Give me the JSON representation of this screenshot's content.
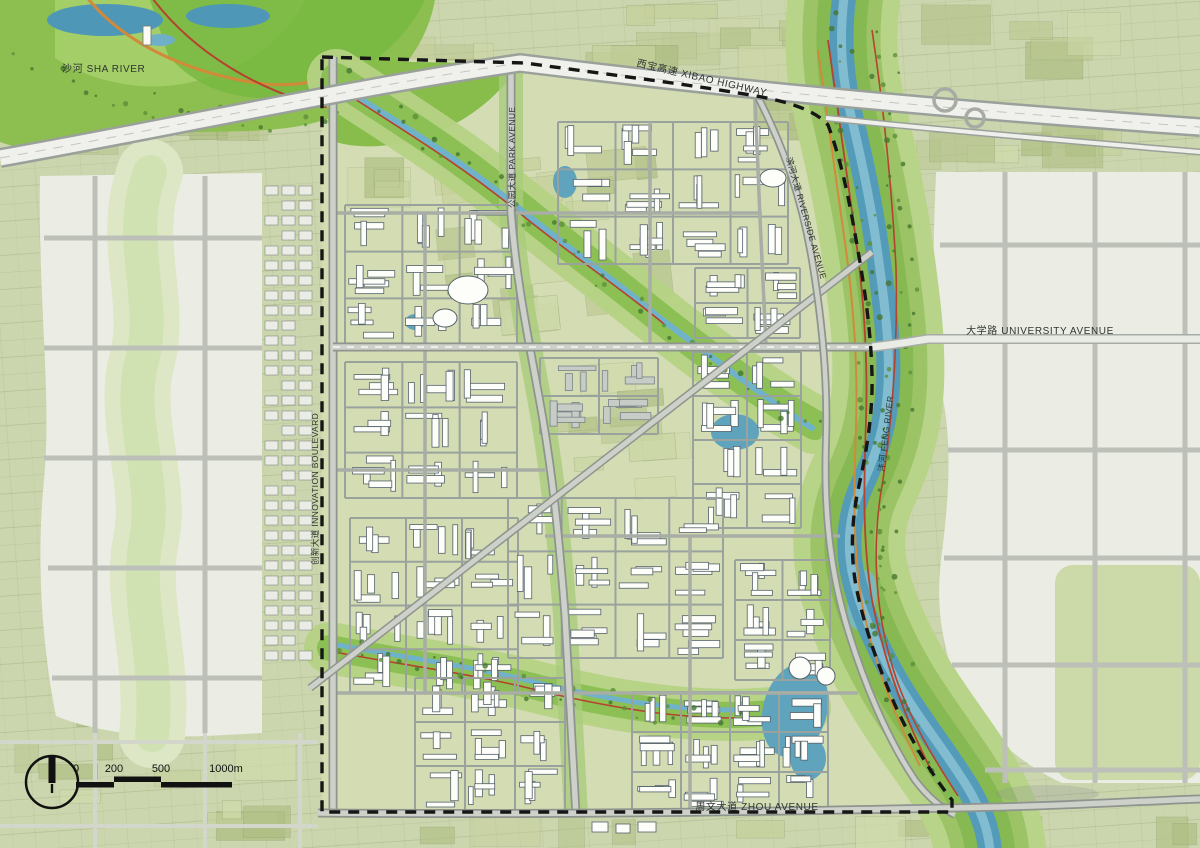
{
  "title": "urban-master-plan-map",
  "labels": {
    "sha_river": "沙河 SHA RIVER",
    "xibao_highway": "西宝高速 XIBAO HIGHWAY",
    "park_avenue": "公园大道 PARK AVENUE",
    "riverside_avenue": "滨河大道 RIVERSIDE AVENUE",
    "university_avenue": "大学路 UNIVERSITY AVENUE",
    "feng_river": "沣河 FENG RIVER",
    "zhou_avenue": "周文大道 ZHOU AVENUE",
    "innovation_boulevard": "创新大道 INNOVATION BOULEVARD"
  },
  "scale_bar": {
    "ticks": [
      "0",
      "200",
      "500",
      "1000m"
    ]
  },
  "north_arrow": {
    "icon": "north-arrow-icon"
  },
  "colors": {
    "field_base": "#ccd6ae",
    "site_base": "#d3dcb2",
    "pale_urban": "#ebede5",
    "park_green": "#8cbf4f",
    "bright_green": "#76b83e",
    "water": "#539bb8",
    "road_gray": "#8e948e",
    "highway_fill": "#f0f1ec",
    "scenic_red": "#b5432e",
    "scenic_orange": "#d08a3a",
    "boundary_black": "#161616",
    "building_white": "#fdfdfa",
    "building_gray": "#c7ccc7"
  }
}
